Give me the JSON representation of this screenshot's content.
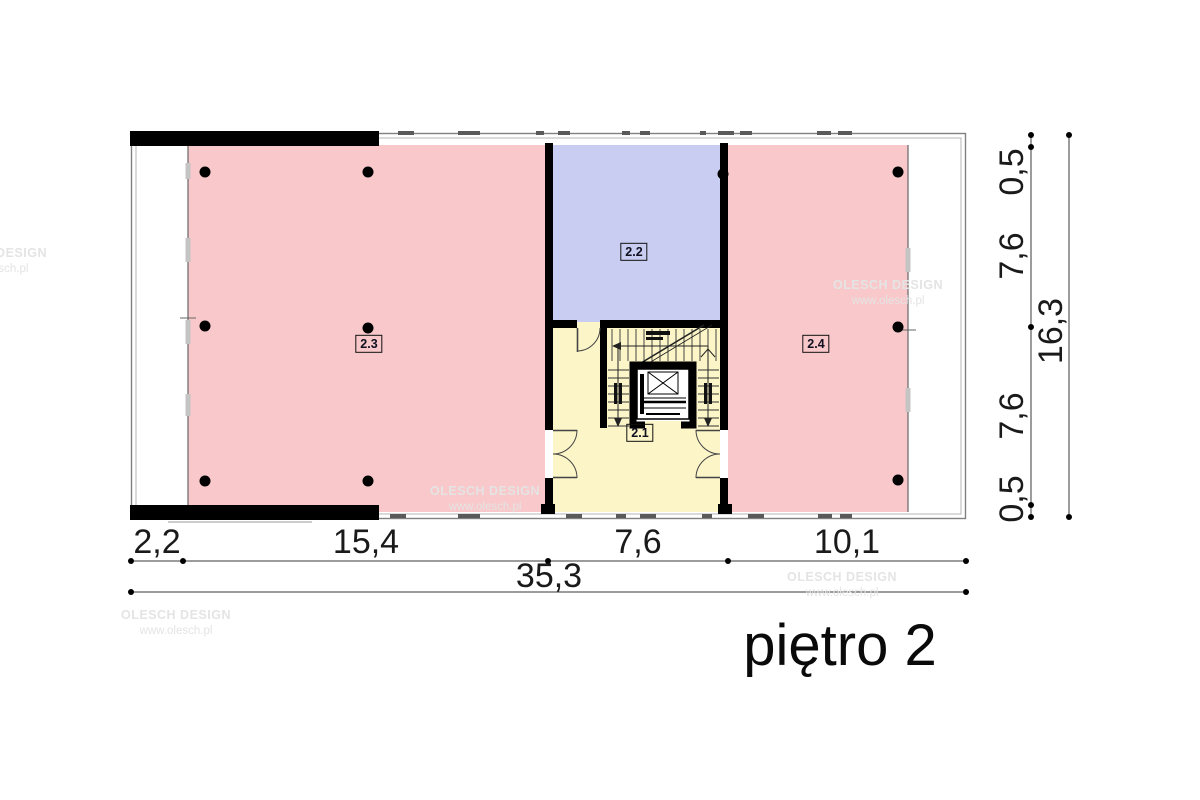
{
  "title": "piętro 2",
  "watermark": {
    "line1": "OLESCH DESIGN",
    "line2": "www.olesch.pl"
  },
  "rooms": {
    "hall": {
      "number": "2.1"
    },
    "upper": {
      "number": "2.2"
    },
    "left": {
      "number": "2.3"
    },
    "right": {
      "number": "2.4"
    }
  },
  "dimensions": {
    "bottom": {
      "segments": [
        "2,2",
        "15,4",
        "7,6",
        "10,1"
      ],
      "total": "35,3"
    },
    "right": {
      "segments": [
        "0,5",
        "7,6",
        "7,6",
        "0,5"
      ],
      "total": "16,3"
    }
  },
  "colors": {
    "room_pink": "#f9c8ca",
    "room_blue": "#c8cdf1",
    "room_yellow": "#fbf5c8",
    "wall": "#000000",
    "outline_gray": "#808080",
    "watermark_gray": "#e4e4e4"
  }
}
